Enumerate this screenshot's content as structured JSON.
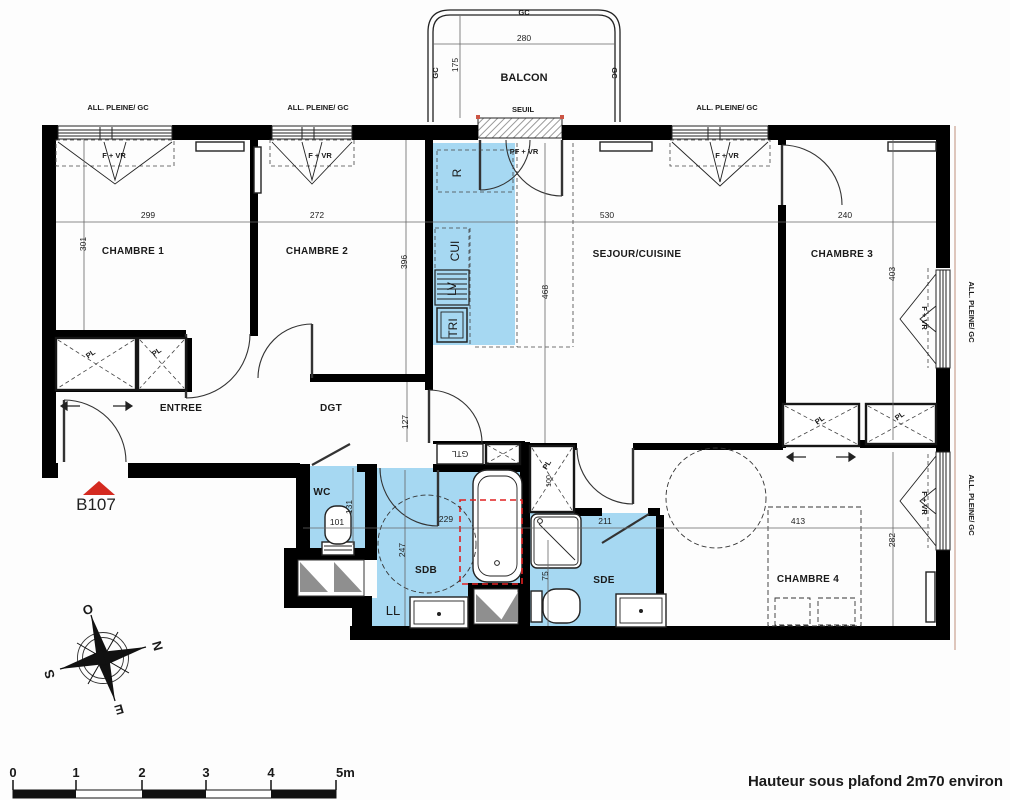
{
  "unit": {
    "label": "B107"
  },
  "footer": {
    "note": "Hauteur sous plafond 2m70 environ"
  },
  "balcony": {
    "label": "BALCON",
    "seuil": "SEUIL",
    "gc": "GC",
    "width": "280",
    "depth": "175",
    "door": "PF + VR"
  },
  "win": {
    "allege": "ALL. PLEINE/ GC",
    "fvr": "F + VR"
  },
  "closets": {
    "pl": "PL",
    "pl_dim": "100"
  },
  "rooms": {
    "c1": {
      "name": "CHAMBRE 1",
      "w": "299",
      "h": "301"
    },
    "c2": {
      "name": "CHAMBRE 2",
      "w": "272",
      "h": "396"
    },
    "sejour": {
      "name": "SEJOUR/CUISINE",
      "w": "530",
      "h": "468"
    },
    "c3": {
      "name": "CHAMBRE 3",
      "w": "240",
      "h": "403"
    },
    "c4": {
      "name": "CHAMBRE 4",
      "w": "413",
      "h": "282"
    },
    "entree": {
      "name": "ENTREE"
    },
    "dgt": {
      "name": "DGT",
      "h": "127"
    },
    "wc": {
      "name": "WC",
      "w": "101",
      "h": "131"
    },
    "sdb": {
      "name": "SDB",
      "w": "229",
      "h": "247"
    },
    "sde": {
      "name": "SDE",
      "w": "211",
      "h": "75"
    }
  },
  "kitchen": {
    "r": "R",
    "cui": "CUI",
    "lv": "LV",
    "tri": "TRI",
    "gtl": "GTL",
    "ll": "LL"
  },
  "compass": {
    "n": "N",
    "e": "E",
    "s": "S",
    "o": "O"
  },
  "scalebar": {
    "t0": "0",
    "t1": "1",
    "t2": "2",
    "t3": "3",
    "t4": "4",
    "t5": "5m"
  },
  "colors": {
    "wet": "#a6d8f2",
    "wall": "#000000",
    "accent_red": "#d42a20"
  }
}
